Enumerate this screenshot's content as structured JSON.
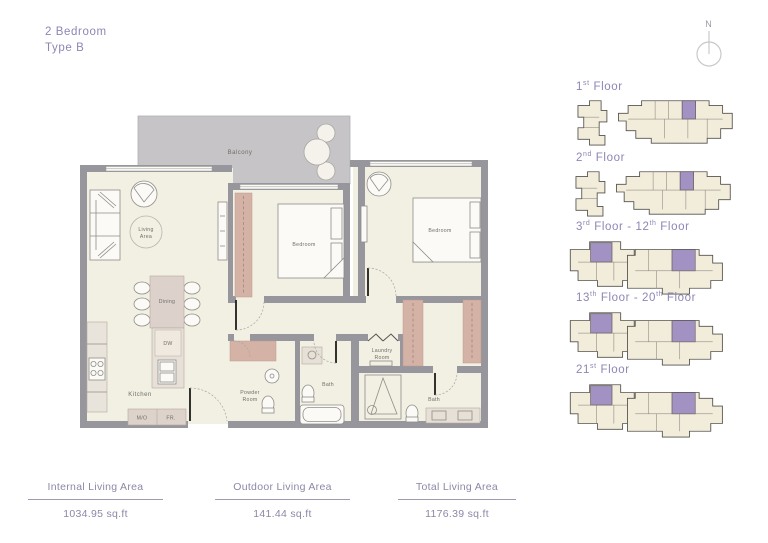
{
  "header": {
    "title_line1": "2 Bedroom",
    "title_line2": "Type B"
  },
  "compass": {
    "label": "N"
  },
  "floorplan": {
    "rooms": {
      "balcony": "Balcony",
      "living": [
        "Living",
        "Area"
      ],
      "dining": "Dining",
      "dw": "DW",
      "kitchen": "Kitchen",
      "mo": "M/O",
      "fr": "FR.",
      "bedroom_1": "Bedroom",
      "bedroom_2": "Bedroom",
      "powder": [
        "Powder",
        "Room"
      ],
      "bath_1": "Bath",
      "laundry": [
        "Laundry",
        "Room"
      ],
      "bath_2": "Bath"
    }
  },
  "key_plans": [
    {
      "label_parts": [
        {
          "t": "1"
        },
        {
          "s": "st"
        },
        {
          "t": " Floor"
        }
      ],
      "type": "split"
    },
    {
      "label_parts": [
        {
          "t": "2"
        },
        {
          "s": "nd"
        },
        {
          "t": " Floor"
        }
      ],
      "type": "split"
    },
    {
      "label_parts": [
        {
          "t": "3"
        },
        {
          "s": "rd"
        },
        {
          "t": " Floor - 12"
        },
        {
          "s": "th"
        },
        {
          "t": " Floor"
        }
      ],
      "type": "wide"
    },
    {
      "label_parts": [
        {
          "t": "13"
        },
        {
          "s": "th"
        },
        {
          "t": " Floor - 20"
        },
        {
          "s": "th"
        },
        {
          "t": " Floor"
        }
      ],
      "type": "wide"
    },
    {
      "label_parts": [
        {
          "t": "21"
        },
        {
          "s": "st"
        },
        {
          "t": " Floor"
        }
      ],
      "type": "wide"
    }
  ],
  "stats": [
    {
      "label": "Internal Living Area",
      "value": "1034.95 sq.ft"
    },
    {
      "label": "Outdoor Living Area",
      "value": "141.44 sq.ft"
    },
    {
      "label": "Total Living Area",
      "value": "1176.39 sq.ft"
    }
  ],
  "colors": {
    "accent": "#8d86b5",
    "wall": "#97969c",
    "floor": "#f2efe3",
    "balcony": "#c6c4c7",
    "wardrobe": "#d4b2a6",
    "kp-unit": "#a292c4",
    "stats": "#8b88a6"
  }
}
